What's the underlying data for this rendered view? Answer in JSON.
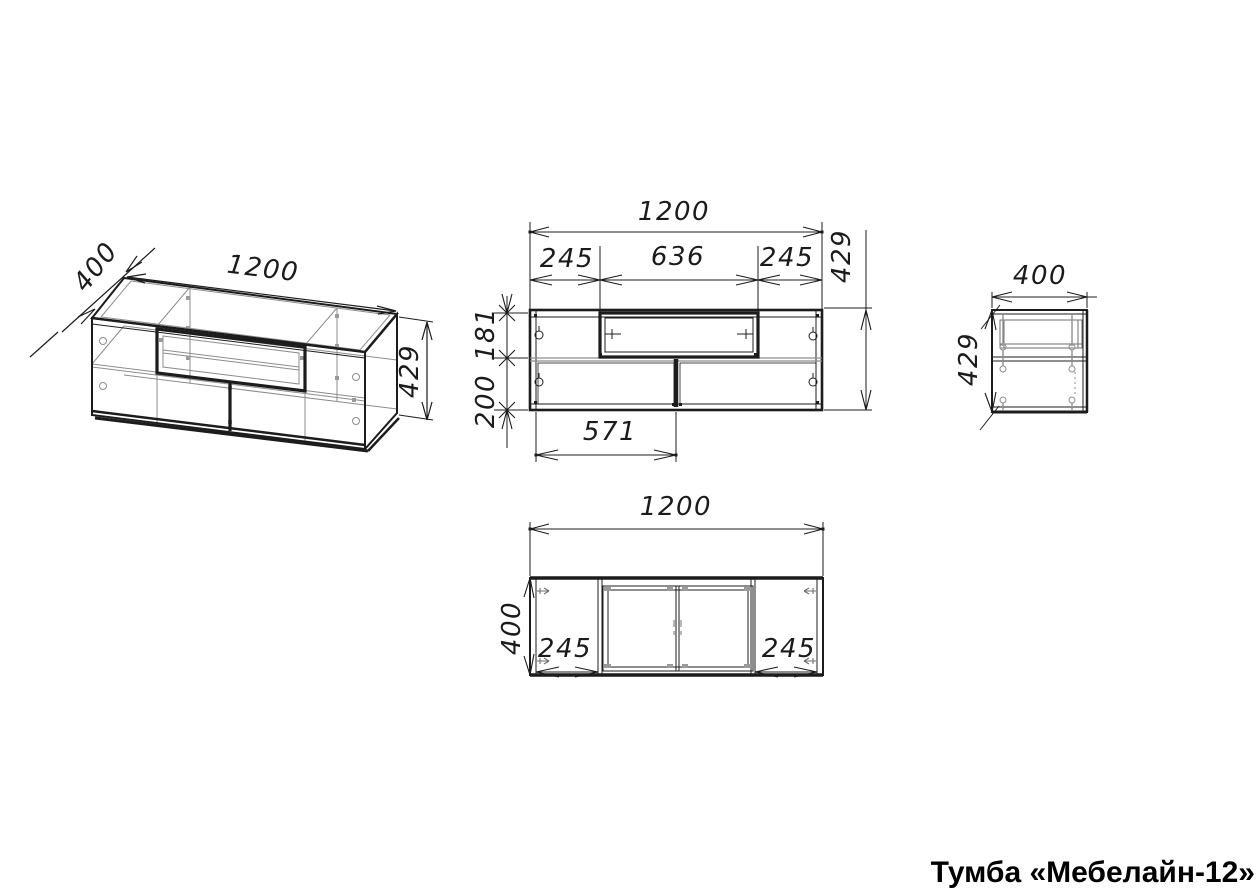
{
  "title": "Тумба «Мебелайн-12»",
  "views": {
    "isometric": {
      "width": "1200",
      "depth": "400",
      "height": "429"
    },
    "front": {
      "width": "1200",
      "section_left": "245",
      "section_middle": "636",
      "section_right": "245",
      "height": "429",
      "inner_top_height": "181",
      "inner_bottom_height": "200",
      "door_width": "571"
    },
    "side": {
      "depth": "400",
      "height": "429"
    },
    "top": {
      "width": "1200",
      "depth": "400",
      "section_left": "245",
      "section_right": "245"
    }
  }
}
